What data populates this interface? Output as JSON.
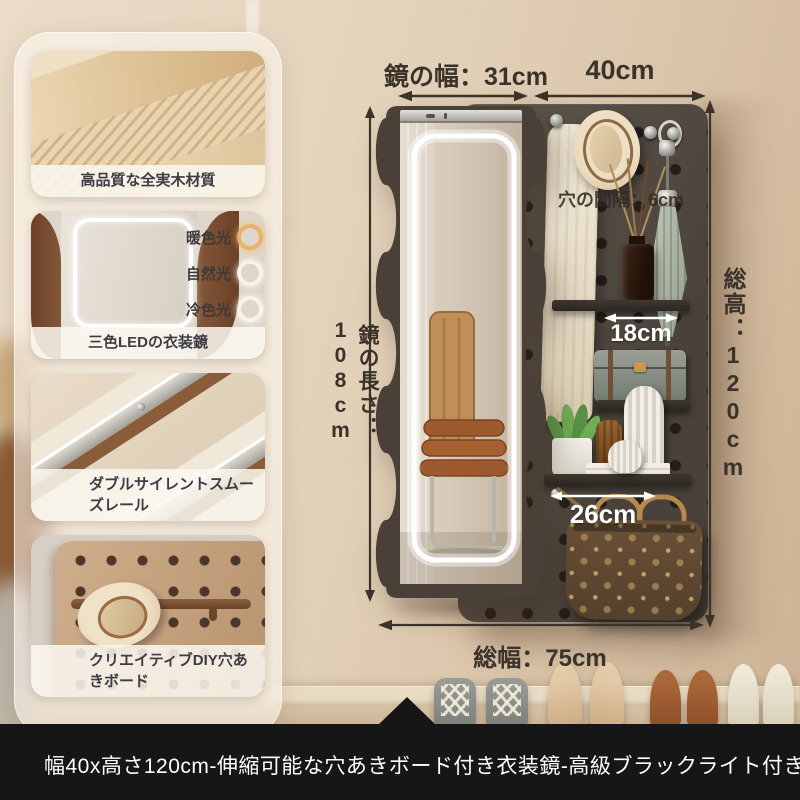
{
  "dimensions": {
    "mirror_width_label": "鏡の幅：31cm",
    "board_width_label": "40cm",
    "mirror_height_label": "鏡の長さ：108cm",
    "total_height_label": "総高：120cm",
    "hole_spacing_label": "穴の間隔：6cm",
    "upper_shelf_label": "18cm",
    "lower_shelf_label": "26cm",
    "total_width_label": "総幅：75cm"
  },
  "sidebar": {
    "cards": [
      {
        "caption": "高品質な全実木材質"
      },
      {
        "caption": "三色LEDの衣装鏡",
        "light_modes": [
          "暖色光",
          "自然光",
          "冷色光"
        ]
      },
      {
        "caption": "ダブルサイレントスムーズレール"
      },
      {
        "caption": "クリエイティブDIY穴あきボード"
      }
    ]
  },
  "footer": {
    "title": "幅40x高さ120cm-伸縮可能な穴あきボード付き衣装鏡-高級ブラックライト付き"
  },
  "colors": {
    "annotation_dark": "#3b332a",
    "annotation_light": "#ffffff",
    "banner_bg": "#161616",
    "banner_text": "#ffffff",
    "warm_light_ring": "#e8b269",
    "white_light_ring": "#f8f3e8",
    "mirror_frame": "#4a4037",
    "pegboard": "#55493f"
  }
}
